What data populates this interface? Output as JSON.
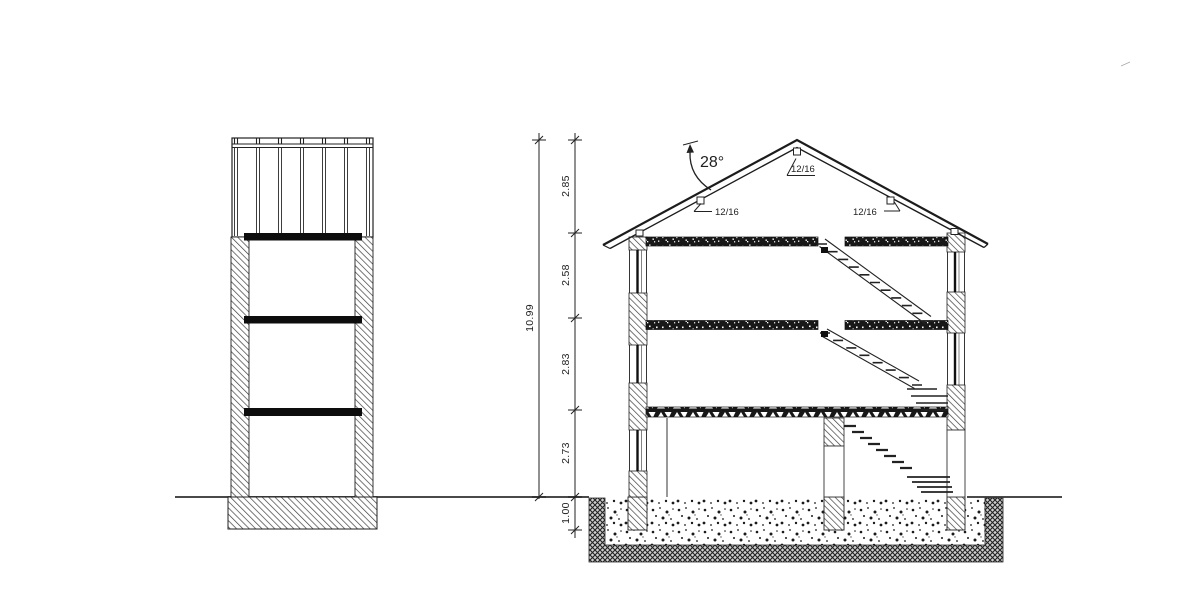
{
  "drawing": {
    "type": "architectural-building-section",
    "colors": {
      "line": "#1f1f1f",
      "background": "#ffffff",
      "slab_fill": "#181818"
    },
    "dimension_lines": {
      "total_height": "10.99",
      "segments": [
        "2.85",
        "2.58",
        "2.83",
        "2.73",
        "1.00"
      ]
    },
    "roof": {
      "angle": "28°",
      "pitch_labels": [
        "12/16",
        "12/16",
        "12/16"
      ]
    }
  }
}
